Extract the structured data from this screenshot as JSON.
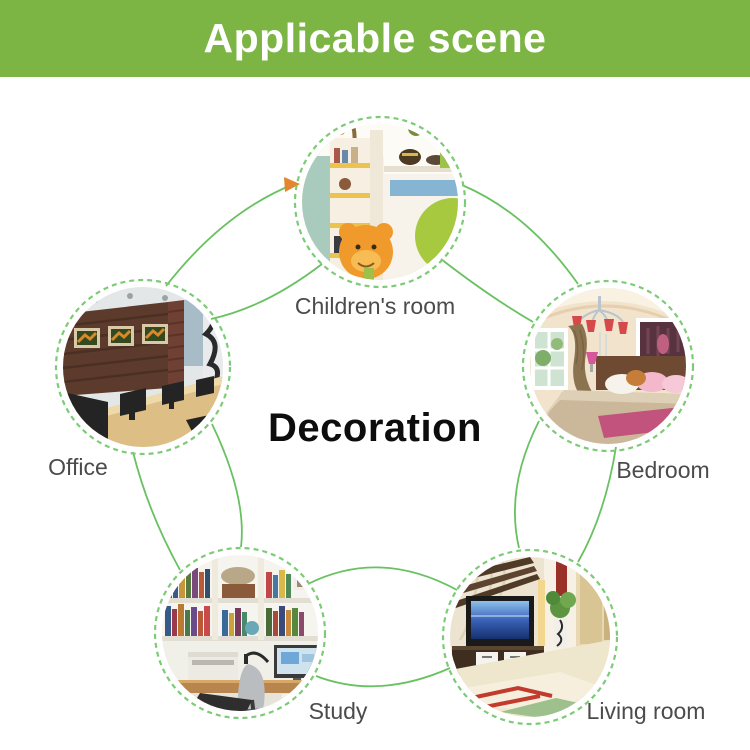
{
  "header": {
    "title": "Applicable scene",
    "background_color": "#7cb544",
    "text_color": "#ffffff"
  },
  "diagram": {
    "center_label": "Decoration",
    "connector_color": "#69c161",
    "ring_color": "#7dcb76",
    "label_color": "#4b4b4b",
    "arrow_icon": {
      "name": "orange-arrowhead-icon",
      "color": "#e2862f"
    },
    "scenes": [
      {
        "id": "children-room",
        "label": "Children's room",
        "position": "top"
      },
      {
        "id": "bedroom",
        "label": "Bedroom",
        "position": "right"
      },
      {
        "id": "living-room",
        "label": "Living room",
        "position": "bottom-right"
      },
      {
        "id": "study",
        "label": "Study",
        "position": "bottom-left"
      },
      {
        "id": "office",
        "label": "Office",
        "position": "left"
      }
    ]
  }
}
